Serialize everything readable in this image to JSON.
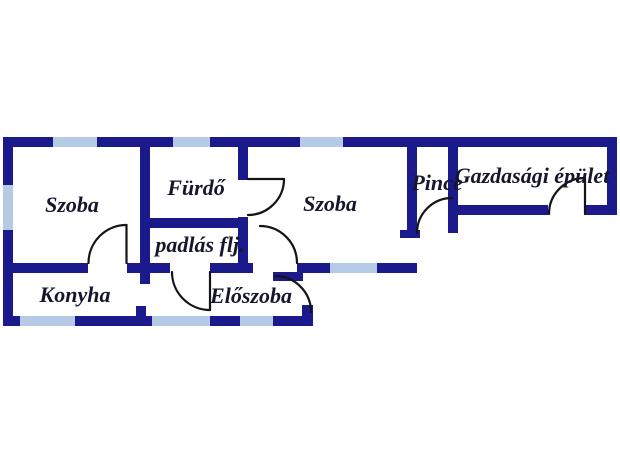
{
  "plan": {
    "rooms": {
      "szoba1": {
        "label": "Szoba"
      },
      "furdo": {
        "label": "Fürdő"
      },
      "padlas": {
        "label": "padlás flj."
      },
      "szoba2": {
        "label": "Szoba"
      },
      "pince": {
        "label": "Pince"
      },
      "gazdasagi": {
        "label": "Gazdasági épület"
      },
      "konyha": {
        "label": "Konyha"
      },
      "eloszoba": {
        "label": "Előszoba"
      }
    },
    "colors": {
      "wall": "#1a1a8c",
      "window": "#b5cbe5",
      "door": "#141414",
      "label": "#16162c",
      "background": "#ffffff"
    }
  }
}
